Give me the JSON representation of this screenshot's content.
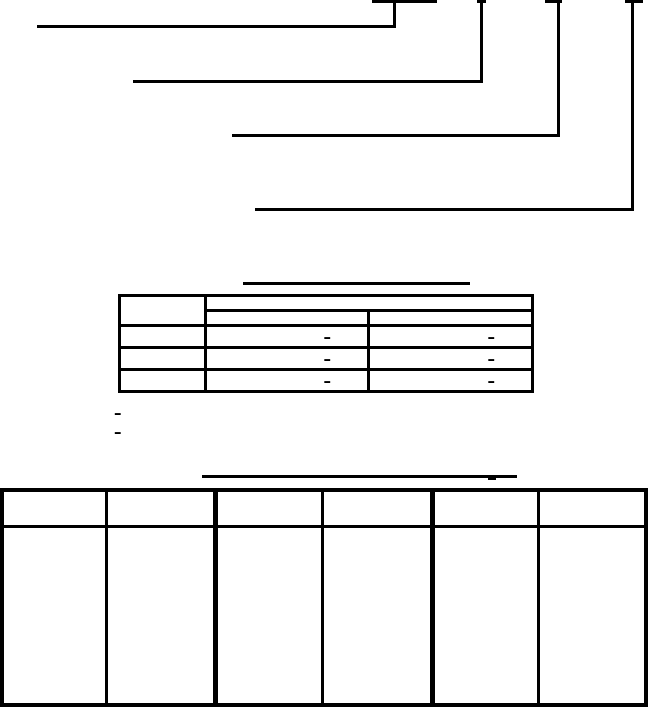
{
  "page": {
    "background_color": "#ffffff",
    "line_color": "#000000"
  },
  "part_number_diagram": {
    "callout_count": 4,
    "segment_underlines": [
      {
        "label": ""
      },
      {
        "label": ""
      },
      {
        "label": ""
      },
      {
        "label": ""
      }
    ],
    "callout_labels": [
      "",
      "",
      "",
      ""
    ]
  },
  "middle_table": {
    "title": "",
    "header": {
      "col1": "",
      "group": "",
      "sub1": "",
      "sub2": ""
    },
    "rows": [
      {
        "col1": "",
        "col2": "–",
        "col3": "–"
      },
      {
        "col1": "",
        "col2": "–",
        "col3": "–"
      },
      {
        "col1": "",
        "col2": "–",
        "col3": "–"
      }
    ]
  },
  "footnote_markers": [
    "–",
    "–"
  ],
  "bottom_table": {
    "title": "",
    "headers": [
      "",
      "",
      "",
      "",
      "",
      ""
    ],
    "body_row": [
      "",
      "",
      "",
      "",
      "",
      ""
    ]
  }
}
